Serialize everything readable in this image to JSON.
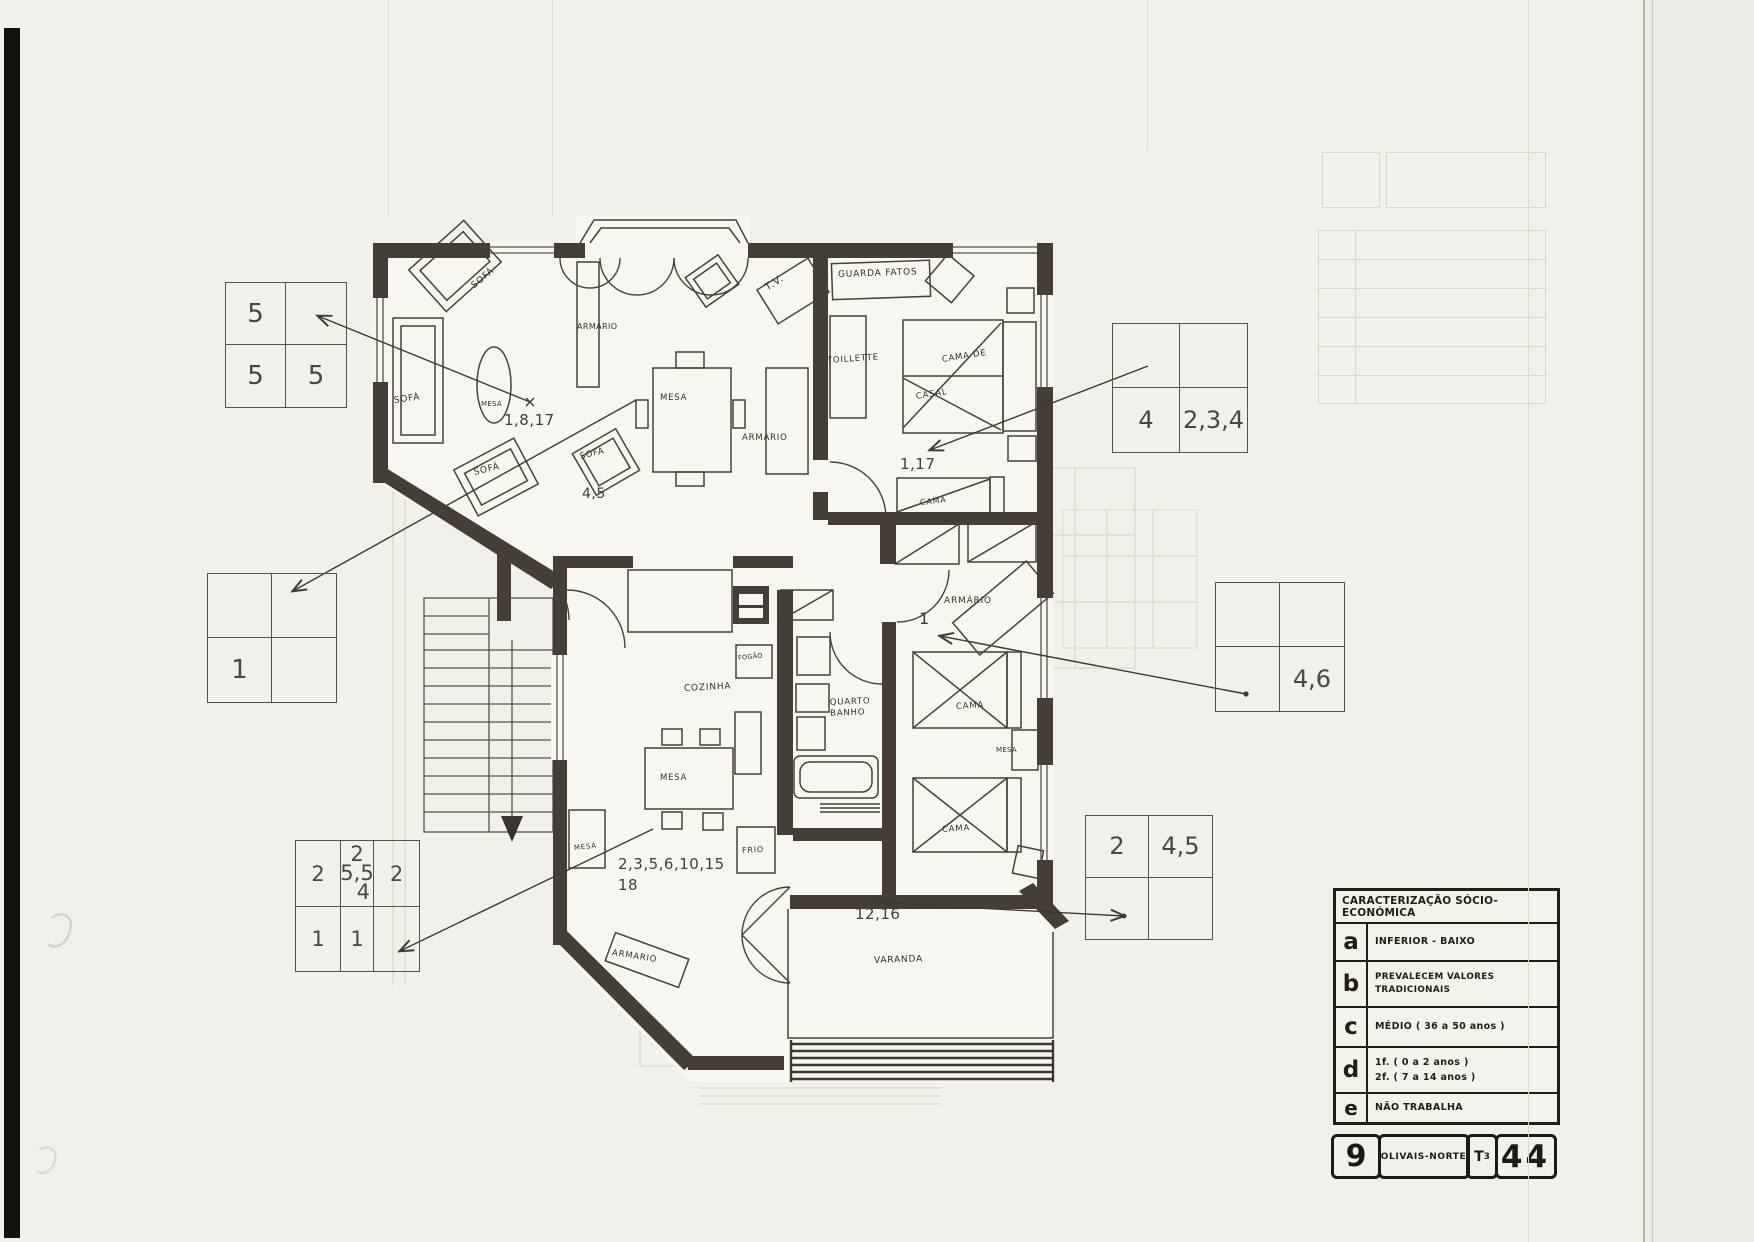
{
  "colors": {
    "paper": "#f2f0ea",
    "wall": "#463e34",
    "ink": "#474139",
    "legend_ink": "#221d17"
  },
  "plan_labels": {
    "sofa": "SOFÁ",
    "mesa": "MESA",
    "armario": "ARMARIO",
    "armario_accented": "ARMÁRIO",
    "tv": "T.V.",
    "guarda_fatos": "GUARDA FATOS",
    "toillette": "TOILLETTE",
    "cama_de": "CAMA DE",
    "casal": "CASAL",
    "cama": "CAMA",
    "cozinha": "COZINHA",
    "fogao": "FOGÃO",
    "frio": "FRIO",
    "quarto": "QUARTO",
    "banho": "BANHO",
    "varanda": "VARANDA"
  },
  "refs": {
    "living_mesa": "1,8,17",
    "hall": "4,5",
    "bedroom1": "1,17",
    "bedroom2": "1",
    "kitchen_line1": "2,3,5,6,10,15",
    "kitchen_line2": "18",
    "varanda": "12,16"
  },
  "grids": {
    "g1": {
      "tl": "5",
      "tr": "",
      "bl": "5",
      "br": "5"
    },
    "g2": {
      "tl": "",
      "tr": "",
      "bl": "4",
      "br": "2,3,4"
    },
    "g3": {
      "tl": "",
      "tr": "",
      "bl": "1",
      "br": ""
    },
    "g4": {
      "r1c1": "2",
      "r1c2_top": "2",
      "r1c2_mid": "5,5",
      "r1c2_bot": "4",
      "r1c3": "2",
      "r2c1": "1",
      "r2c2": "1",
      "r2c3": ""
    },
    "g5": {
      "tl": "",
      "tr": "",
      "bl": "",
      "br": "4,6"
    },
    "g6": {
      "tl": "2",
      "tr": "4,5",
      "bl": "",
      "br": ""
    }
  },
  "legend": {
    "title": "CARACTERIZAÇÃO SÓCIO-ECONÓMICA",
    "row_a_key": "a",
    "row_a_text": "INFERIOR - BAIXO",
    "row_b_key": "b",
    "row_b_text": "PREVALECEM VALORES TRADICIONAIS",
    "row_c_key": "c",
    "row_c_text": "MÉDIO ( 36 a 50 anos )",
    "row_d_key": "d",
    "row_d_line1": "1f. ( 0 a 2 anos )",
    "row_d_line2": "2f. ( 7 a 14 anos )",
    "row_e_key": "e",
    "row_e_text": "NÃO TRABALHA"
  },
  "title_block": {
    "number": "9",
    "name": "OLIVAIS-NORTE",
    "typology": "T",
    "typology_sub": "3",
    "code": "44"
  }
}
